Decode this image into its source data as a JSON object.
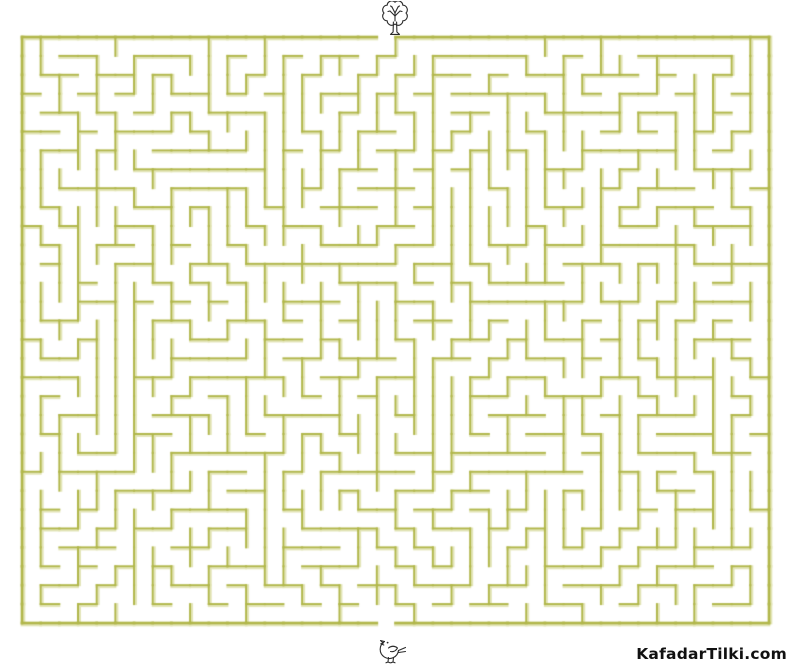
{
  "page": {
    "width": 791,
    "height": 666,
    "background": "#ffffff",
    "title": "Maze puzzle worksheet"
  },
  "maze": {
    "rows": 31,
    "cols": 40,
    "x": 22,
    "y": 37,
    "width": 747,
    "height": 586,
    "wall_color": "#b1b74b",
    "wall_highlight": "#e3e5b8",
    "wall_width": 2,
    "border_width": 2.7,
    "seed": 1337,
    "entrance": {
      "side": "top",
      "col": 19
    },
    "exit": {
      "side": "bottom",
      "col": 19
    }
  },
  "icons": {
    "start": "tree-icon",
    "end": "bird-icon",
    "line_color": "#2a2a2a"
  },
  "footer": {
    "site_label": "KafadarTilki.com"
  }
}
